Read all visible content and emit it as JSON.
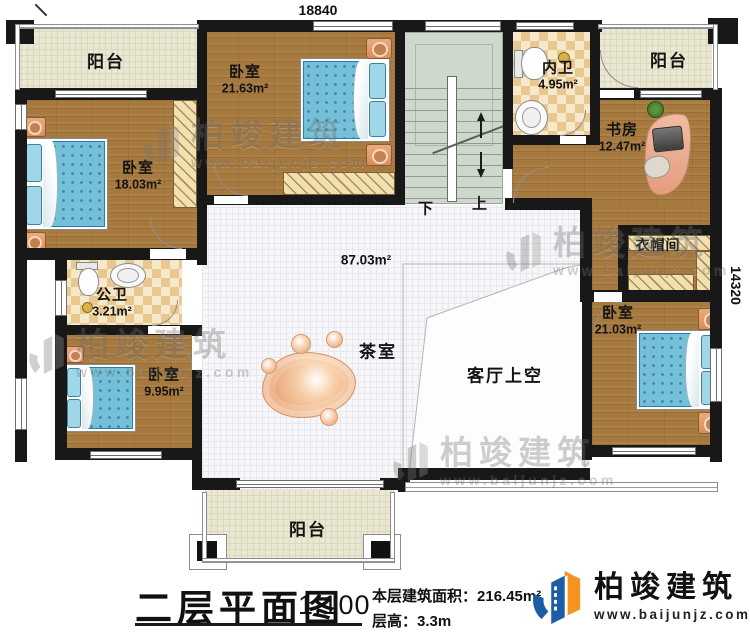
{
  "plan": {
    "dim_top": "18840",
    "dim_right": "14320",
    "hall_area": "87.03m²",
    "stair_down": "下",
    "stair_up": "上",
    "rooms": {
      "balcony_tl": {
        "name": "阳台"
      },
      "bedroom_tl": {
        "name": "卧室",
        "area": "21.63m²"
      },
      "bedroom_left": {
        "name": "卧室",
        "area": "18.03m²"
      },
      "inner_bath": {
        "name": "内卫",
        "area": "4.95m²"
      },
      "balcony_tr": {
        "name": "阳台"
      },
      "study": {
        "name": "书房",
        "area": "12.47m²"
      },
      "cloakroom": {
        "name": "衣帽间"
      },
      "public_bath": {
        "name": "公卫",
        "area": "3.21m²"
      },
      "bedroom_bl": {
        "name": "卧室",
        "area": "9.95m²"
      },
      "bedroom_right": {
        "name": "卧室",
        "area": "21.03m²"
      },
      "tea_room": {
        "name": "茶室"
      },
      "living_void": {
        "name": "客厅上空"
      },
      "balcony_bottom": {
        "name": "阳台"
      }
    }
  },
  "watermark": {
    "brand": "柏竣建筑",
    "url": "www.baijunjz.com"
  },
  "titleblock": {
    "title": "二层平面图",
    "scale": "1:100",
    "area_label": "本层建筑面积：",
    "area_value": "216.45m²",
    "floor_height": "层高：3.3m",
    "brand": "柏竣建筑",
    "brand_url": "www.baijunjz.com"
  },
  "colors": {
    "wood": "#a6793e",
    "tile": "#f7f7f9",
    "balcony": "#eae7d2",
    "stairs": "#cfd8cd",
    "bed": "#74c0d8",
    "wall": "#181818",
    "logo_blue": "#1b5ea6",
    "logo_orange": "#f6921e"
  }
}
